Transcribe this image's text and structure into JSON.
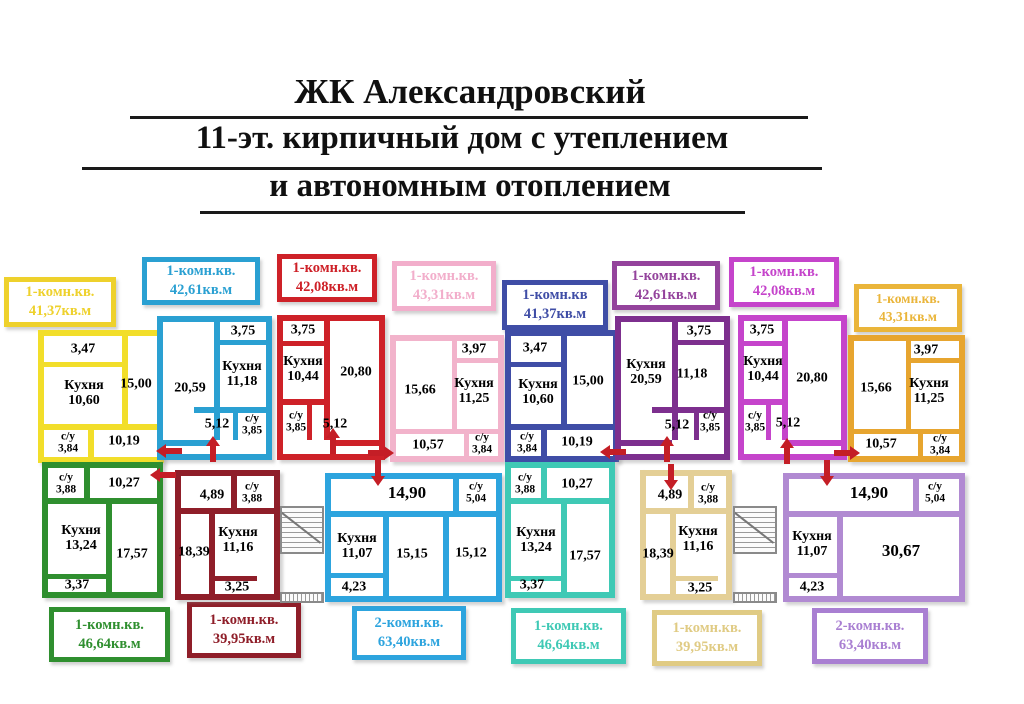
{
  "title": {
    "line1": "ЖК Александровский",
    "line2": "11-эт. кирпичный дом с утеплением",
    "line3": "и автономным отоплением"
  },
  "legend_top": [
    {
      "type": "1-комн.кв.",
      "area": "41,37кв.м",
      "color": "#eed12c"
    },
    {
      "type": "1-комн.кв.",
      "area": "42,61кв.м",
      "color": "#2aa0d2"
    },
    {
      "type": "1-комн.кв.",
      "area": "42,08кв.м",
      "color": "#ce2128"
    },
    {
      "type": "1-комн.кв.",
      "area": "43,31кв.м",
      "color": "#f2aecb"
    },
    {
      "type": "1-комн.кв",
      "area": "41,37кв.м",
      "color": "#3f4da6"
    },
    {
      "type": "1-комн.кв.",
      "area": "42,61кв.м",
      "color": "#94439c"
    },
    {
      "type": "1-комн.кв.",
      "area": "42,08кв.м",
      "color": "#c544cb"
    },
    {
      "type": "1-комн.кв.",
      "area": "43,31кв.м",
      "color": "#eab53a"
    }
  ],
  "legend_bottom": [
    {
      "type": "1-комн.кв.",
      "area": "46,64кв.м",
      "color": "#2f8f2f"
    },
    {
      "type": "1-комн.кв.",
      "area": "39,95кв.м",
      "color": "#8f1e29"
    },
    {
      "type": "2-комн.кв.",
      "area": "63,40кв.м",
      "color": "#2da4de"
    },
    {
      "type": "1-комн.кв.",
      "area": "46,64кв.м",
      "color": "#3fc9b5"
    },
    {
      "type": "1-комн.кв.",
      "area": "39,95кв.м",
      "color": "#e0cb84"
    },
    {
      "type": "2-комн.кв.",
      "area": "63,40кв.м",
      "color": "#a97fd2"
    }
  ],
  "apartments": {
    "a1": {
      "balcony": "3,47",
      "kitchen": "Кухня\n10,60",
      "room": "15,00",
      "bath": "с/у\n3,84",
      "hall": "10,19"
    },
    "a2": {
      "balcony": "3,75",
      "room": "20,59",
      "kitchen": "Кухня\n11,18",
      "hall": "5,12",
      "bath": "с/у\n3,85"
    },
    "a3": {
      "balcony": "3,75",
      "kitchen": "Кухня\n10,44",
      "room": "20,80",
      "bath": "с/у\n3,85",
      "hall": "5,12"
    },
    "a4": {
      "room": "15,66",
      "balcony": "3,97",
      "kitchen": "Кухня\n11,25",
      "hall": "10,57",
      "bath": "с/у\n3,84"
    },
    "a5": {
      "balcony": "3,47",
      "kitchen": "Кухня\n10,60",
      "room": "15,00",
      "bath": "с/у\n3,84",
      "hall": "10,19"
    },
    "a6": {
      "kitchen": "Кухня\n20,59",
      "room": "11,18",
      "balcony": "3,75",
      "hall": "5,12",
      "bath": "с/у\n3,85"
    },
    "a7": {
      "balcony": "3,75",
      "kitchen": "Кухня\n10,44",
      "room": "20,80",
      "bath": "с/у\n3,85",
      "hall": "5,12"
    },
    "a8": {
      "room": "15,66",
      "balcony": "3,97",
      "kitchen": "Кухня\n11,25",
      "hall": "10,57",
      "bath": "с/у\n3,84"
    },
    "b1": {
      "bath": "с/у\n3,88",
      "hall": "10,27",
      "kitchen": "Кухня\n13,24",
      "room": "17,57",
      "balcony": "3,37"
    },
    "b2": {
      "hall": "4,89",
      "bath": "с/у\n3,88",
      "room": "18,39",
      "kitchen": "Кухня\n11,16",
      "balcony": "3,25"
    },
    "b3": {
      "hall": "14,90",
      "bath": "с/у\n5,04",
      "kitchen": "Кухня\n11,07",
      "room1": "15,15",
      "room2": "15,12",
      "balcony": "4,23"
    },
    "b4": {
      "bath": "с/у\n3,88",
      "hall": "10,27",
      "kitchen": "Кухня\n13,24",
      "room": "17,57",
      "balcony": "3,37"
    },
    "b5": {
      "hall": "4,89",
      "bath": "с/у\n3,88",
      "room": "18,39",
      "kitchen": "Кухня\n11,16",
      "balcony": "3,25"
    },
    "b6": {
      "hall": "14,90",
      "bath": "с/у\n5,04",
      "kitchen": "Кухня\n11,07",
      "room": "30,67",
      "balcony": "4,23"
    }
  }
}
